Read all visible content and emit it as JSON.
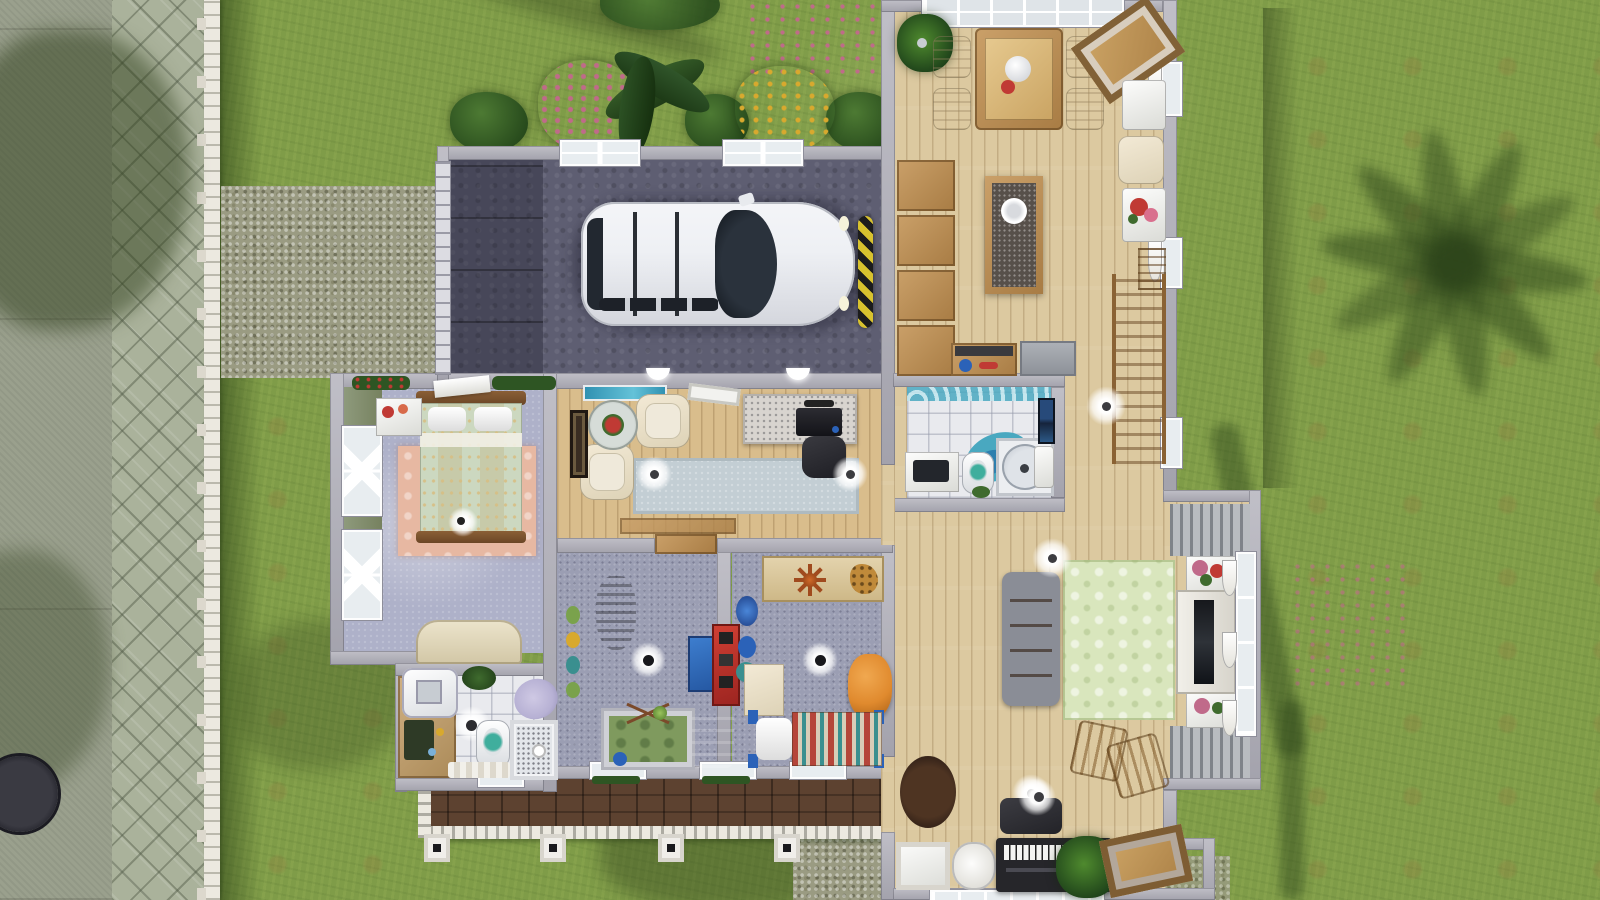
{
  "scene": {
    "title": "The Sims 3 — overhead cutaway view of a one-story suburban family house",
    "view": "top-down floor plan with roof removed, daytime",
    "palette": {
      "grass": "#7f9c48",
      "grassShade": "#3c5a24",
      "sidewalk": "#9aa08d",
      "paver": "#aab29b",
      "gravel": "#9a9b82",
      "fence": "#ece9e0",
      "wall": "#a3a2ac",
      "wallLight": "#c0bfc7",
      "garageFloor": "#5e5e72",
      "woodFloor": "#dcc9a0",
      "woodStudy": "#d9bd8c",
      "porchWood": "#5d4230",
      "carpetKids": "#9b9eb3",
      "carpetBedroom": "#aeb1c9",
      "tile": "#e9eaee",
      "rugGreen": "#d9e6bd",
      "rugPink": "#e7b8a2",
      "rugStudy": "#c3ced4",
      "sofaBrown": "#7c4f28",
      "cabinetWood": "#b98d54",
      "carWhite": "#eef0f4",
      "bumperYellow": "#d8c22e",
      "aquaTeal": "#49a8c0",
      "lavender": "#b7b1d4",
      "cribGreen": "#7f9a5e",
      "kidBedRed": "#b5453a",
      "kidBedTeal": "#3a8f8f",
      "poufOrange": "#e08a2e",
      "plantGreen": "#2e5523",
      "flowerPink": "#c06a8a",
      "flowerYellow": "#d8a92e",
      "flowerRed": "#c03a34",
      "bedspread": "#ccd8c0",
      "pianoBlack": "#26262a",
      "sageWall": "#8e9a7c"
    },
    "exterior": {
      "features": [
        "concrete sidewalk along left edge with tree shadows",
        "herringbone paver path running north-south",
        "white picket fence with posts along the path",
        "gravel driveway leading to garage",
        "front lawn with dirt patches and scattered pink flowers",
        "flower bed behind garage: pink bush, banana plant, yellow flower bush, green shrubs",
        "large palm tree shadow on right lawn",
        "manhole cover on sidewalk bottom-left",
        "front porch with dark wood deck, white railing and four square columns",
        "gravel walk at porch's right end"
      ]
    },
    "rooms": [
      {
        "id": "garage",
        "name": "Garage",
        "furniture": [
          "white family minivan",
          "segmented garage door (west wall)",
          "two four-pane windows (north wall)",
          "yellow-black parking bumper",
          "dark concrete floor"
        ]
      },
      {
        "id": "dining-room",
        "name": "Dining room",
        "furniture": [
          "wooden dining table with white vase and red flowers",
          "four cream dining chairs",
          "potted palm",
          "diagonal wood-framed picture",
          "glass skylight wall (north)",
          "white side tables with red flowers",
          "cream armchair"
        ]
      },
      {
        "id": "kitchen",
        "name": "Kitchen",
        "furniture": [
          "column of four wooden pantry shelves",
          "kitchen island with dark granite top and white plate",
          "wooden counter with utensils",
          "gray refrigerator",
          "wooden staircase along east wall"
        ]
      },
      {
        "id": "main-bathroom",
        "name": "Main bathroom",
        "furniture": [
          "teal wave wallpaper border",
          "white vanity with mirror",
          "toilet",
          "teal two-tone rug",
          "round glass shower stall",
          "wall sink",
          "two blue picture frames",
          "white tile floor"
        ]
      },
      {
        "id": "living-room",
        "name": "Living room",
        "furniture": [
          "brown tufted leather sofa",
          "green diamond-pattern rug",
          "tall brown bookshelf cabinet",
          "white media console with TV in bay window",
          "gray louvered panels",
          "two flower boxes",
          "wooden dining chairs",
          "ceiling lamps",
          "round brown rug"
        ]
      },
      {
        "id": "music-corner",
        "name": "Music corner",
        "furniture": [
          "electronic keyboard piano with bench",
          "white sphere floor lamp",
          "potted palm",
          "leaning wood picture frame",
          "white end table",
          "white rounded pet bed"
        ]
      },
      {
        "id": "master-bedroom",
        "name": "Master bedroom",
        "furniture": [
          "double bed with wood frame, two pillows and pale-green floral spread",
          "salmon pink rug",
          "white nightstand with red decor",
          "cream dresser",
          "two curtained windows (west wall)",
          "sage green accent wall",
          "planter boxes on north wall",
          "sphere lamp"
        ]
      },
      {
        "id": "study",
        "name": "Study",
        "furniture": [
          "aquarium on north wall",
          "two white armchairs",
          "round glass table with red flowers",
          "dark painting on west wall",
          "speckled desk with black computer",
          "dark office chair",
          "long gray-blue rug",
          "two ceiling lamps",
          "interior door to hallway"
        ]
      },
      {
        "id": "nursery",
        "name": "Nursery",
        "furniture": [
          "cat scratching post",
          "blue activity table",
          "red toy shelf",
          "crib with green mat and toy mobile",
          "blue rocking chair",
          "wall stickers",
          "gray-blue carpet"
        ]
      },
      {
        "id": "kids-bedroom",
        "name": "Kids bedroom",
        "furniture": [
          "wood wall shelf with spider and giraffe toys",
          "cream dresser",
          "bed with striped blanket, white pillow and blue posts",
          "orange pouf",
          "blue toy bin",
          "gray-blue carpet"
        ]
      },
      {
        "id": "second-bathroom",
        "name": "Second bathroom",
        "furniture": [
          "wood vanity with white sink",
          "lavender tub",
          "toilet",
          "sphere lamp",
          "shower stall",
          "green plant",
          "white bath mat",
          "tile floor"
        ]
      },
      {
        "id": "porch",
        "name": "Front porch",
        "furniture": [
          "dark wood deck",
          "white railing with balusters",
          "four white columns",
          "windows with planter boxes along house wall"
        ]
      }
    ]
  }
}
